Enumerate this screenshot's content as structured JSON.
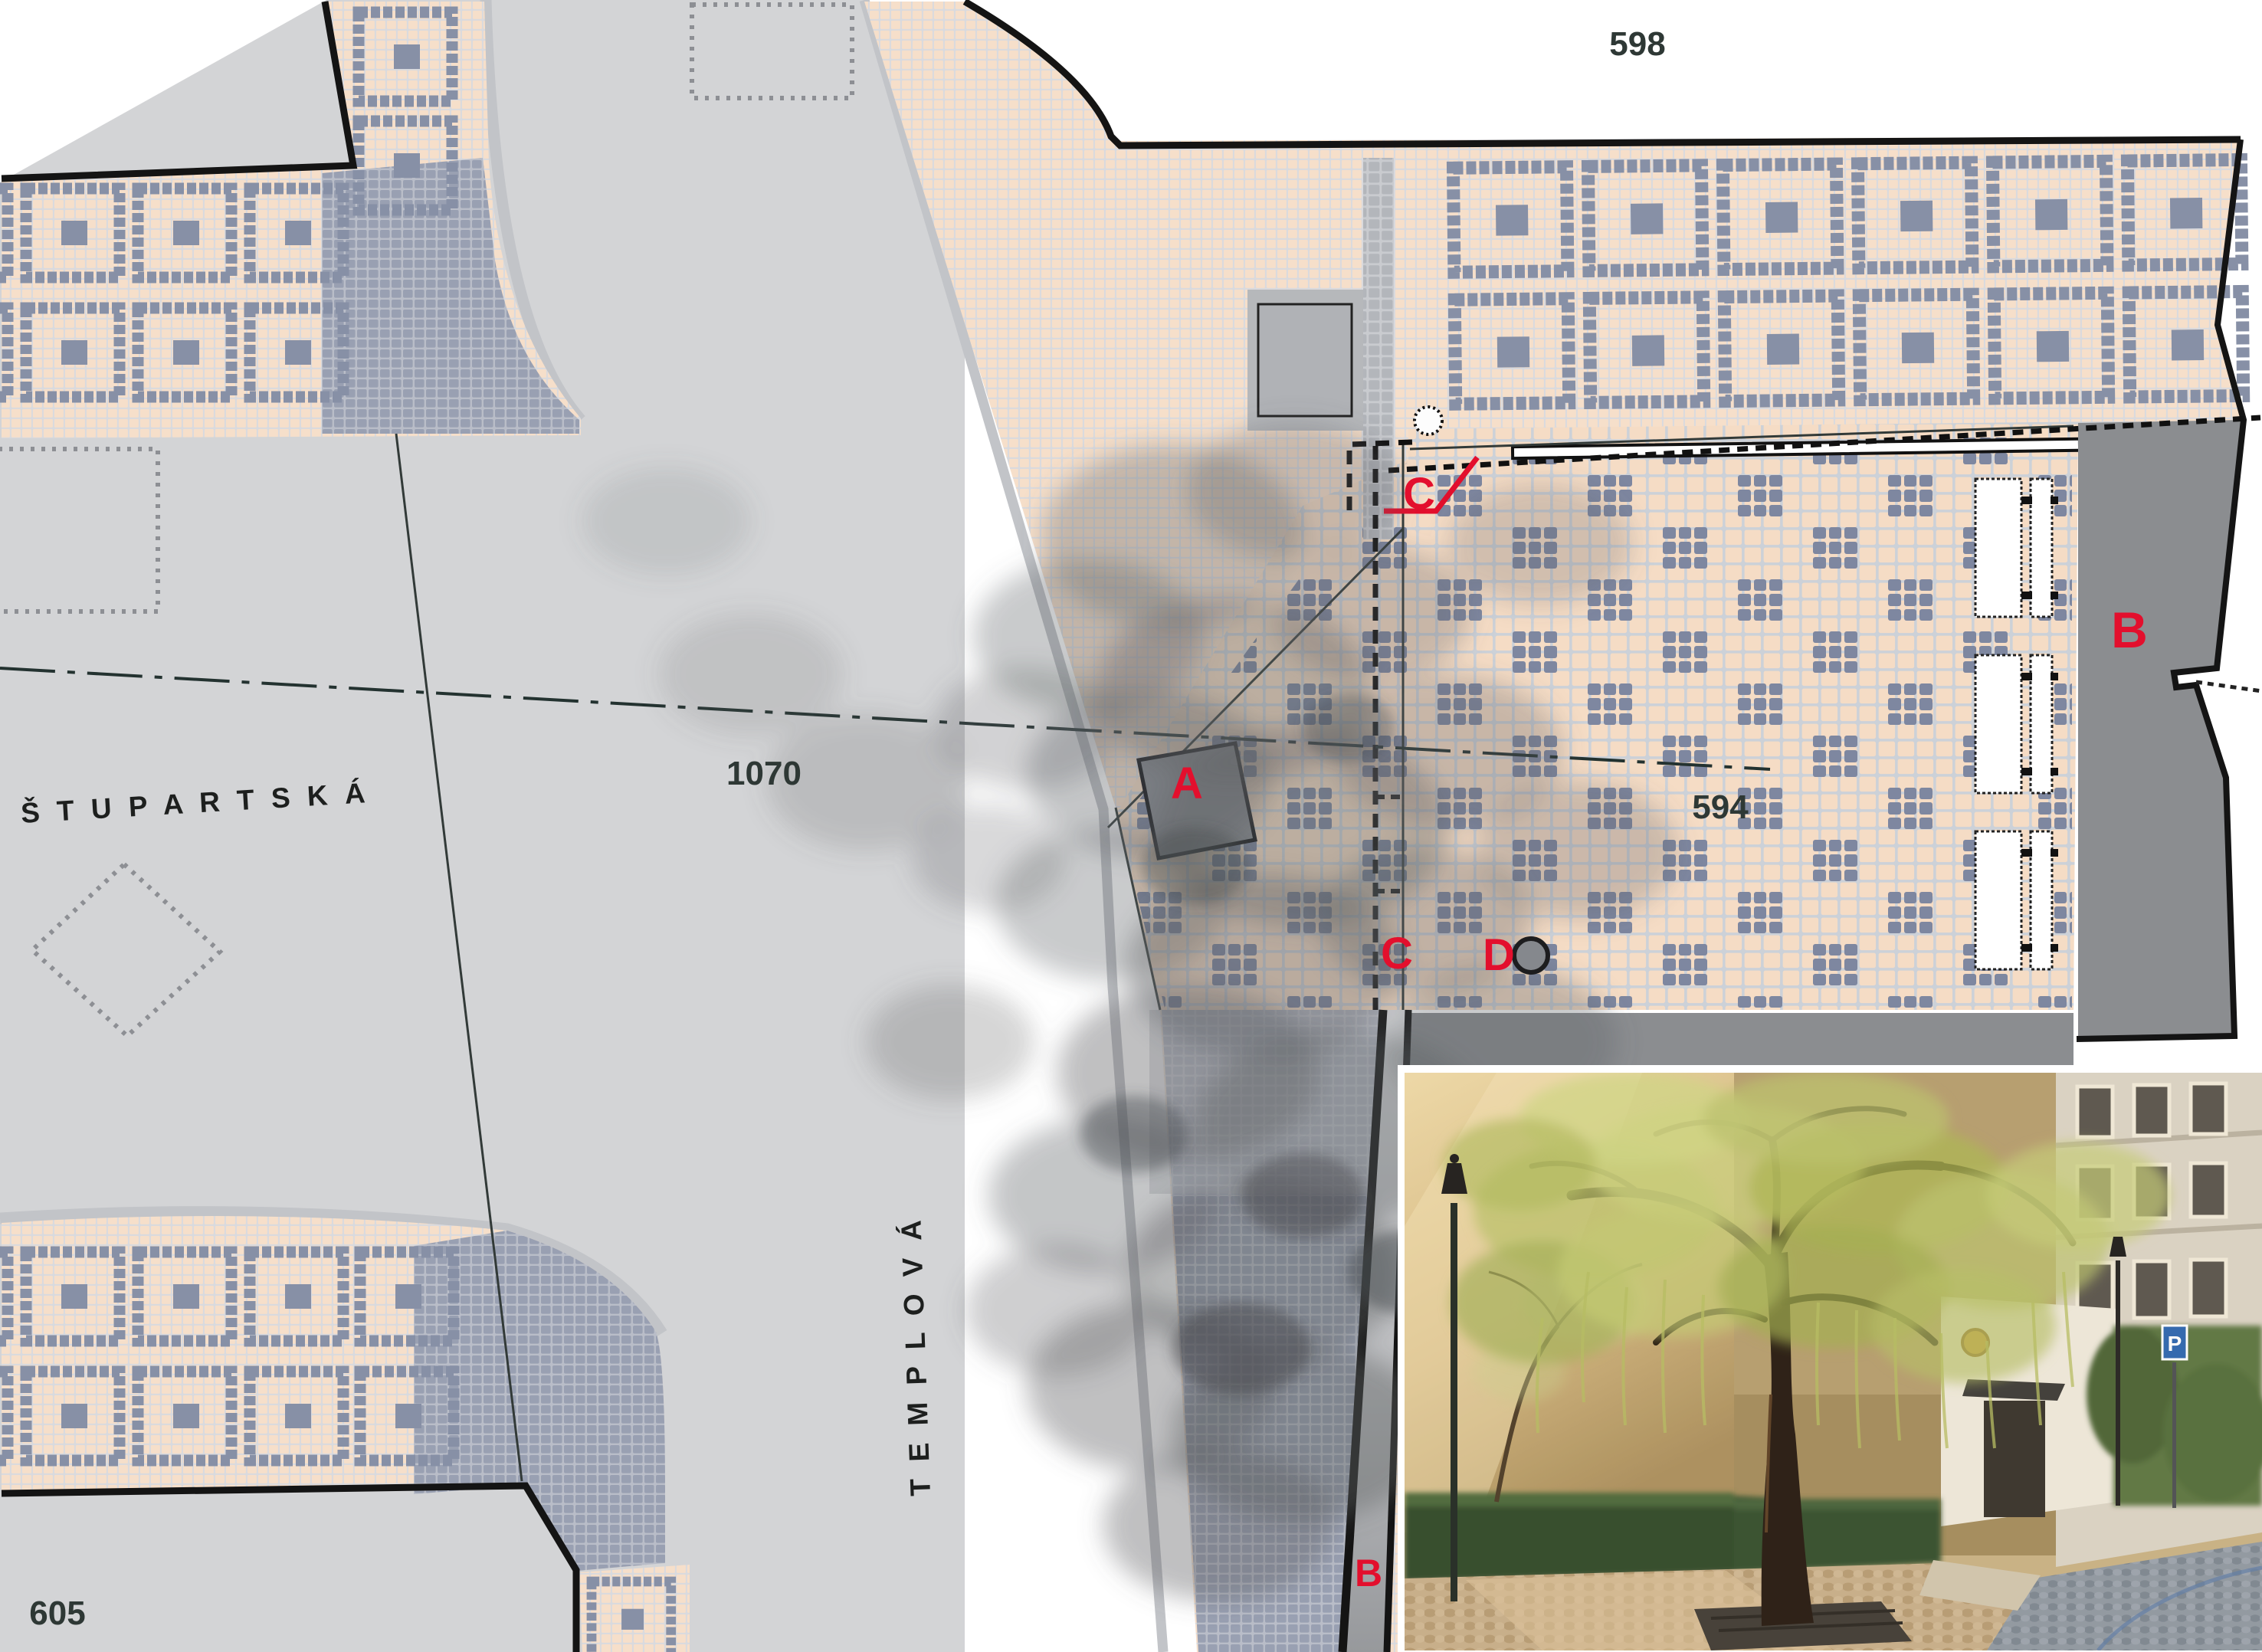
{
  "plan": {
    "street_names": {
      "stupartska": "Š T U P A R T S K Á",
      "templova": "T E M P L O V Á"
    },
    "parcel_numbers": {
      "top": "598",
      "square": "1070",
      "plaza": "594",
      "bottom_left": "605"
    },
    "section_markers": {
      "a": "A",
      "b_building": "B",
      "b_bottom": "B",
      "c_top": "C",
      "c_bottom": "C",
      "d": "D"
    },
    "colors": {
      "street_gray": "#d3d4d6",
      "sidewalk_pink": "#f6dfca",
      "grout": "#d8d9dd",
      "cobble_blue": "#7e87a0",
      "dense_mosaic": "#99a0b2",
      "building_dark": "#8b8d90",
      "marker_red": "#e30f2d",
      "number_dark": "#2e3835",
      "line_black": "#1a1a1a"
    }
  },
  "photo": {
    "parking_sign_letter": "P"
  }
}
